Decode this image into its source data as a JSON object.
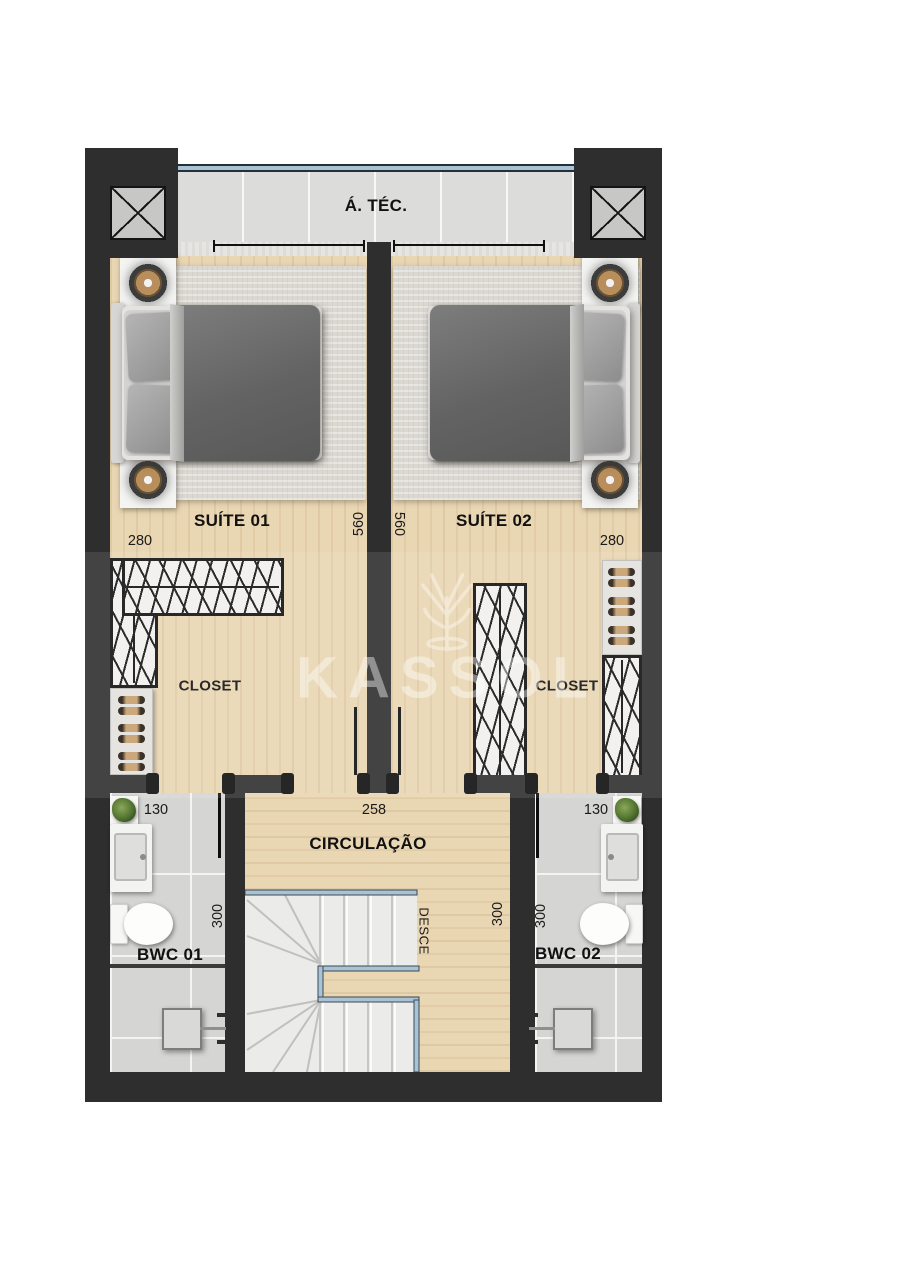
{
  "plan_title": "Floor plan - upper level with two suites",
  "rooms": {
    "tech_area": {
      "name": "Á. TÉC."
    },
    "suite_01": {
      "name": "SUÍTE 01",
      "width_cm": "280",
      "opening_cm": "560"
    },
    "suite_02": {
      "name": "SUÍTE 02",
      "width_cm": "280",
      "opening_cm": "560"
    },
    "closet_01": {
      "name": "CLOSET"
    },
    "closet_02": {
      "name": "CLOSET"
    },
    "circulation": {
      "name": "CIRCULAÇÃO",
      "opening_cm": "258",
      "depth_cm": "300"
    },
    "bwc_01": {
      "name": "BWC 01",
      "door_cm": "130",
      "depth_cm": "300"
    },
    "bwc_02": {
      "name": "BWC 02",
      "door_cm": "130",
      "depth_cm": "300"
    },
    "stairs": {
      "direction_label": "DESCE"
    }
  },
  "watermark": {
    "text": "KASSOL"
  },
  "colors": {
    "wall": "#2e2e2e",
    "wood_floor": "#e9d6b3",
    "bath_tile": "#d5d5d3",
    "rug": "#dbd8d2",
    "accent_blue": "#a9c3d4",
    "duvet": "#636363"
  }
}
